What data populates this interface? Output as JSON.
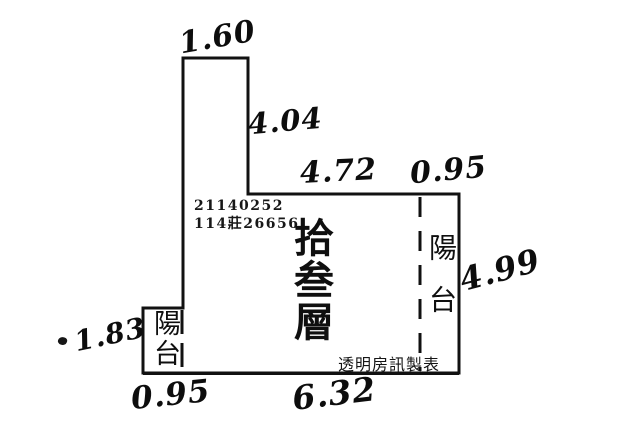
{
  "floor_plan": {
    "registration_number": "21140252",
    "case_number": "114莊26656",
    "floor_label": "拾叁層",
    "balcony_label_right": "陽台",
    "balcony_label_left": "陽台",
    "credit": "透明房訊製表",
    "measurements": {
      "top_width": "1.60",
      "upper_right_height": "4.04",
      "main_top_width": "4.72",
      "right_balcony_width": "0.95",
      "right_height": "4.99",
      "left_balcony_height": "1.83",
      "left_balcony_width": "0.95",
      "bottom_width": "6.32"
    }
  }
}
